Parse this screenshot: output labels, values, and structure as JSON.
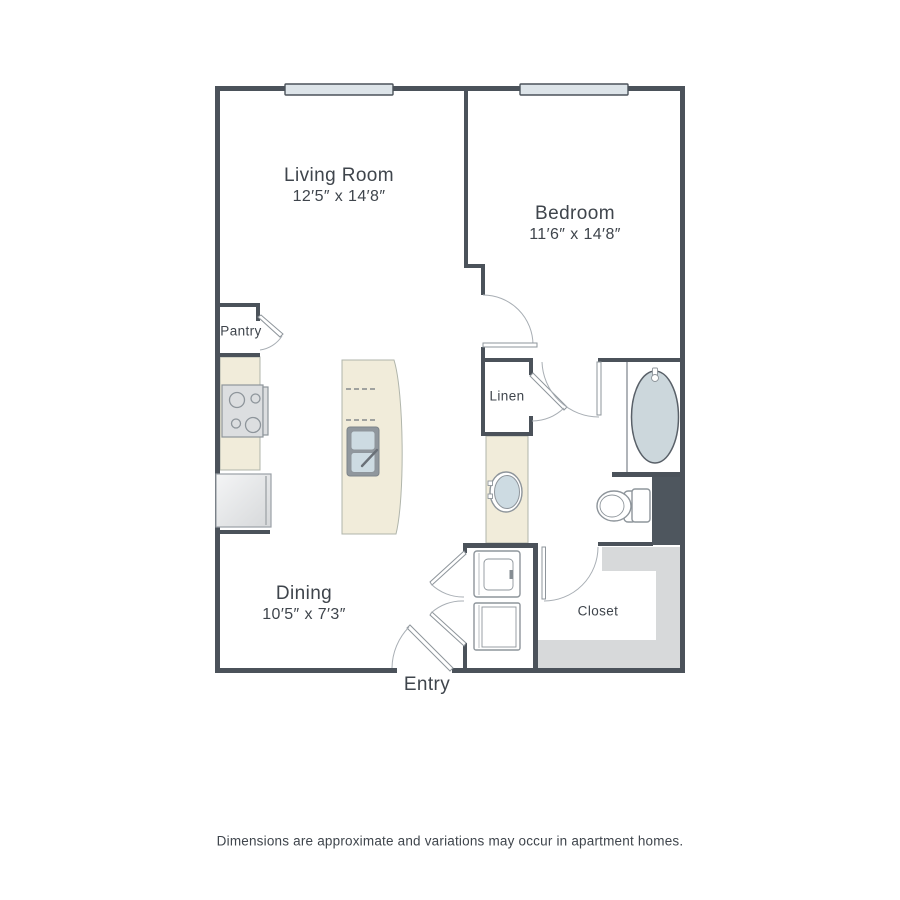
{
  "colors": {
    "wall": "#4b525a",
    "counter_beige": "#f1ecda",
    "fixture_blue": "#cddbe2",
    "tub_blue": "#ccd7dc",
    "window_fill": "#dde4e9",
    "shelf_gray": "#d7d9da",
    "dark_block": "#4e565e",
    "line_gray": "#8e959b",
    "text": "#3f454c"
  },
  "rooms": {
    "living_room": {
      "label": "Living Room",
      "dimensions": "12′5″ x 14′8″"
    },
    "bedroom": {
      "label": "Bedroom",
      "dimensions": "11′6″ x 14′8″"
    },
    "dining": {
      "label": "Dining",
      "dimensions": "10′5″ x 7′3″"
    },
    "pantry": {
      "label": "Pantry"
    },
    "linen": {
      "label": "Linen"
    },
    "closet": {
      "label": "Closet"
    },
    "entry": {
      "label": "Entry"
    }
  },
  "fixtures": [
    "stove",
    "refrigerator",
    "kitchen-island",
    "island-sink",
    "bathroom-sink",
    "bathtub",
    "toilet",
    "washer-dryer-stack",
    "closet-shelves",
    "window",
    "window"
  ],
  "footer": {
    "disclaimer": "Dimensions are approximate and variations may occur in apartment homes."
  }
}
